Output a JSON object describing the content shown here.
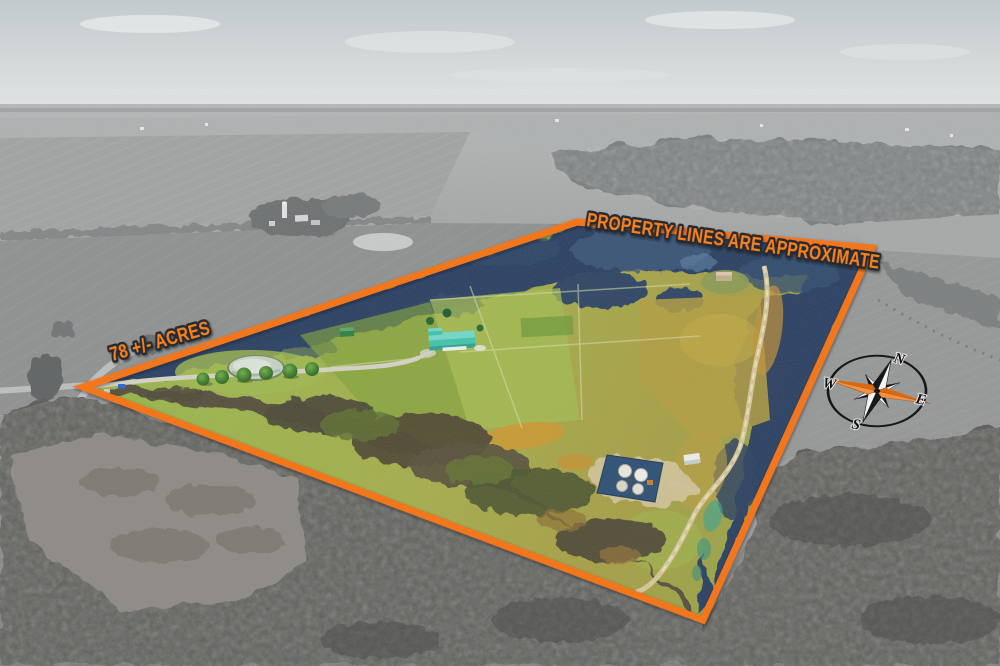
{
  "annotations": {
    "boundary_note": "PROPERTY LINES ARE APPROXIMATE",
    "acreage_label": "78 +/- ACRES"
  },
  "compass": {
    "north": "N",
    "east": "E",
    "south": "S",
    "west": "W"
  },
  "colors": {
    "boundary_orange": "#F2771E",
    "label_fill": "#F6821F",
    "label_outline": "#262A33",
    "compass_accent": "#E8731C"
  }
}
